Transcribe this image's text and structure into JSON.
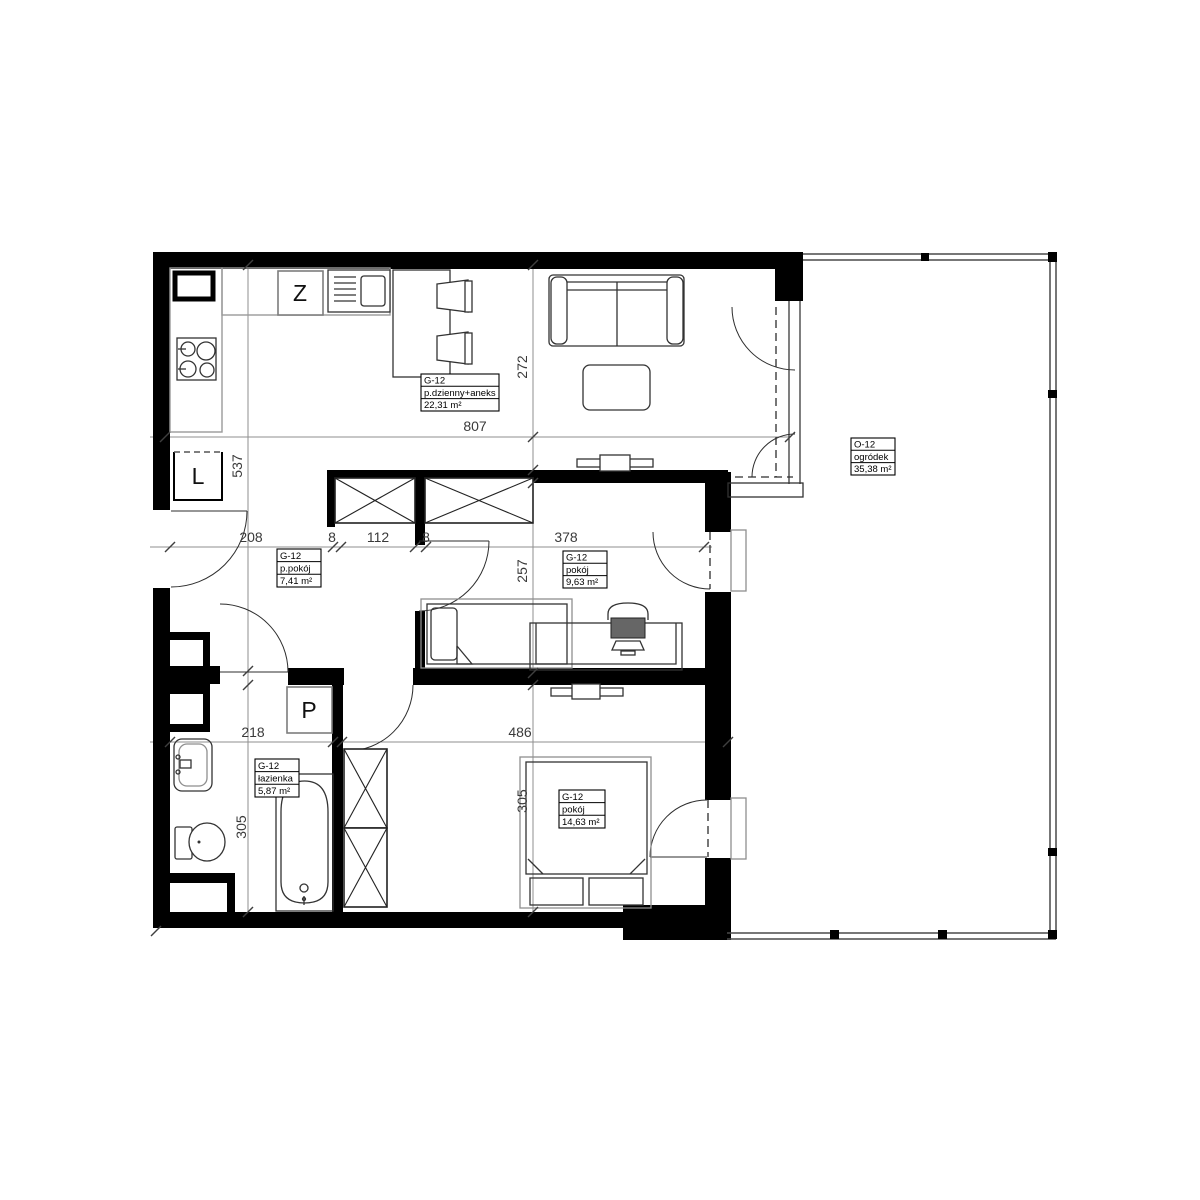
{
  "plan": {
    "labels": {
      "living": {
        "code": "G-12",
        "name": "p.dzienny+aneks",
        "area": "22,31 m²"
      },
      "hall": {
        "code": "G-12",
        "name": "p.pokój",
        "area": "7,41 m²"
      },
      "room2": {
        "code": "G-12",
        "name": "pokój",
        "area": "9,63 m²"
      },
      "bath": {
        "code": "G-12",
        "name": "łazienka",
        "area": "5,87 m²"
      },
      "room1": {
        "code": "G-12",
        "name": "pokój",
        "area": "14,63 m²"
      },
      "garden": {
        "code": "O-12",
        "name": "ogródek",
        "area": "35,38 m²"
      }
    },
    "appliances": {
      "dishwasher": "Z",
      "fridge": "L",
      "washer": "P"
    },
    "dims": {
      "living_width": "807",
      "living_depth": "272",
      "left_height": "537",
      "hall_width": "208",
      "wall_a": "8",
      "wardrobe": "112",
      "wall_b": "8",
      "room2_width": "378",
      "room2_depth": "257",
      "bath_width": "218",
      "room1_width": "486",
      "bath_depth": "305",
      "room1_depth": "305"
    }
  }
}
